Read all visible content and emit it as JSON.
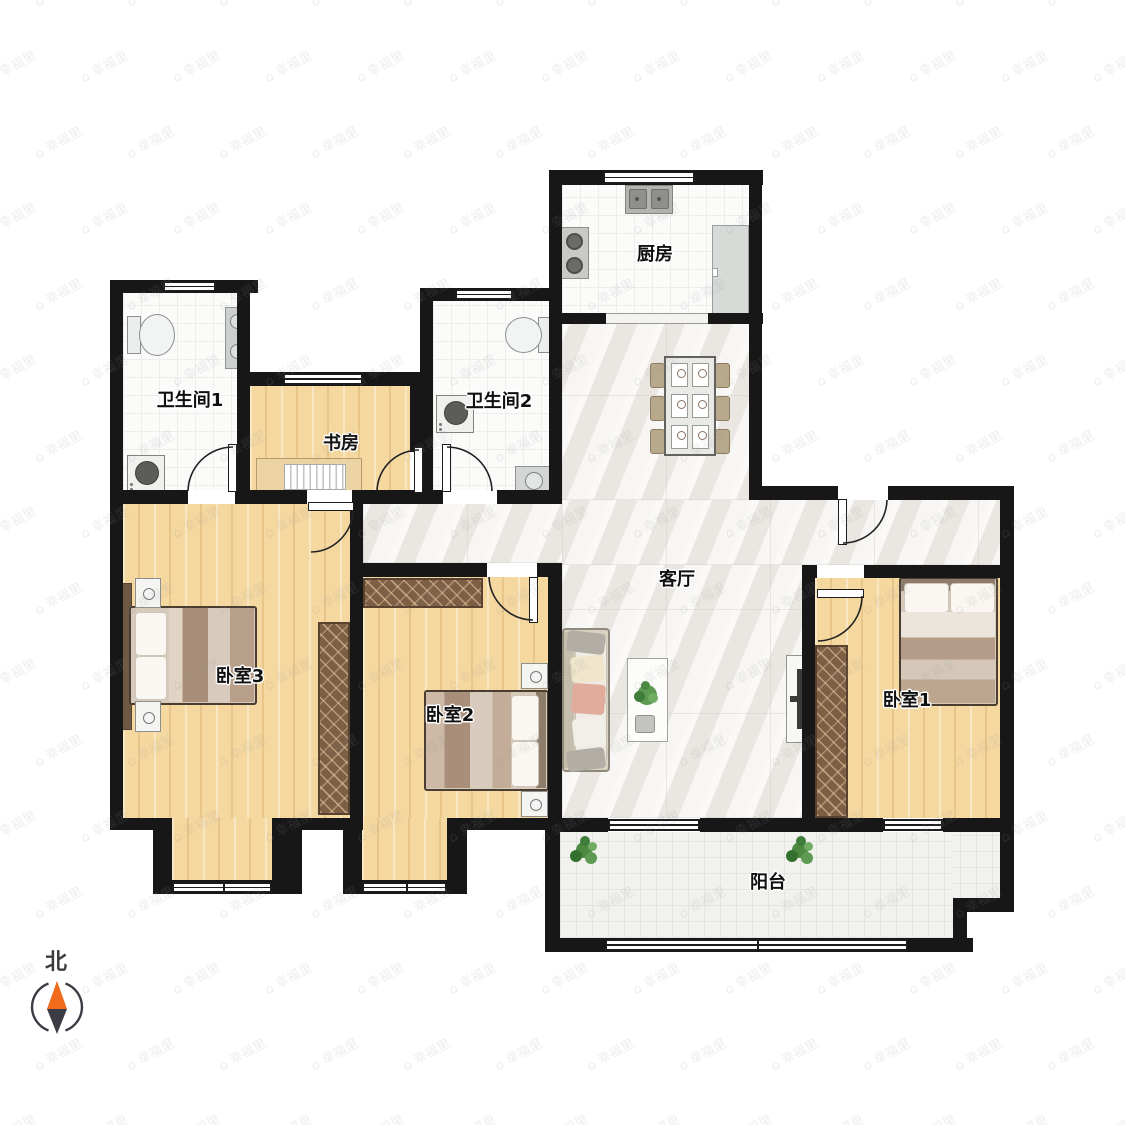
{
  "compass": {
    "north_label": "北"
  },
  "watermark": {
    "text": "幸福里",
    "icon": "house-icon"
  },
  "rooms": {
    "kitchen": {
      "label": "厨房"
    },
    "bathroom1": {
      "label": "卫生间1"
    },
    "bathroom2": {
      "label": "卫生间2"
    },
    "study": {
      "label": "书房"
    },
    "living": {
      "label": "客厅"
    },
    "bedroom1": {
      "label": "卧室1"
    },
    "bedroom2": {
      "label": "卧室2"
    },
    "bedroom3": {
      "label": "卧室3"
    },
    "balcony": {
      "label": "阳台"
    }
  },
  "colors": {
    "wall": "#171717",
    "wood_floor": "#f5d8a0",
    "marble_floor": "#f0eeea",
    "tile_floor": "#fbfbfa",
    "wardrobe": "#7d5f45",
    "plant_green": "#4c8a42",
    "compass_north_needle": "#f26a1b",
    "compass_south_needle": "#3c3c44"
  }
}
